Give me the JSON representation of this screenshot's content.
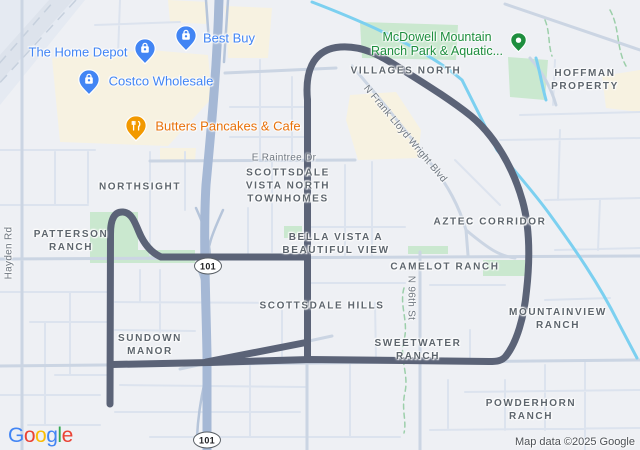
{
  "attribution": "Map data ©2025 Google",
  "logo": {
    "letters": [
      "G",
      "o",
      "o",
      "g",
      "l",
      "e"
    ],
    "colors": [
      "#4285F4",
      "#EA4335",
      "#FBBC04",
      "#4285F4",
      "#34A853",
      "#EA4335"
    ]
  },
  "pois": [
    {
      "name": "the-home-depot",
      "label": "The Home Depot",
      "category": "shopping"
    },
    {
      "name": "best-buy",
      "label": "Best Buy",
      "category": "shopping"
    },
    {
      "name": "costco-wholesale",
      "label": "Costco Wholesale",
      "category": "shopping"
    },
    {
      "name": "butters-pancakes-cafe",
      "label": "Butters Pancakes & Cafe",
      "category": "restaurant"
    },
    {
      "name": "mcdowell-mountain-ranch-park",
      "lines": [
        "McDowell Mountain",
        "Ranch Park & Aquatic..."
      ],
      "category": "park"
    }
  ],
  "neighborhoods": [
    {
      "name": "villages-north",
      "lines": [
        "VILLAGES NORTH"
      ]
    },
    {
      "name": "hoffman-property",
      "lines": [
        "HOFFMAN",
        "PROPERTY"
      ]
    },
    {
      "name": "northsight",
      "lines": [
        "NORTHSIGHT"
      ]
    },
    {
      "name": "patterson-ranch",
      "lines": [
        "PATTERSON",
        "RANCH"
      ]
    },
    {
      "name": "scottsdale-vista-north-townhomes",
      "lines": [
        "SCOTTSDALE",
        "VISTA NORTH",
        "TOWNHOMES"
      ]
    },
    {
      "name": "bella-vista-a-beautiful-view",
      "lines": [
        "BELLA VISTA A",
        "BEAUTIFUL VIEW"
      ]
    },
    {
      "name": "aztec-corridor",
      "lines": [
        "AZTEC CORRIDOR"
      ]
    },
    {
      "name": "camelot-ranch",
      "lines": [
        "CAMELOT RANCH"
      ]
    },
    {
      "name": "scottsdale-hills",
      "lines": [
        "SCOTTSDALE HILLS"
      ]
    },
    {
      "name": "sundown-manor",
      "lines": [
        "SUNDOWN",
        "MANOR"
      ]
    },
    {
      "name": "sweetwater-ranch",
      "lines": [
        "SWEETWATER",
        "RANCH"
      ]
    },
    {
      "name": "mountainview-ranch",
      "lines": [
        "MOUNTAINVIEW",
        "RANCH"
      ]
    },
    {
      "name": "powderhorn-ranch",
      "lines": [
        "POWDERHORN",
        "RANCH"
      ]
    }
  ],
  "road_labels": [
    {
      "name": "e-raintree-dr",
      "text": "E Raintree Dr"
    },
    {
      "name": "n-frank-lloyd-wright-blvd",
      "text": "N Frank Lloyd Wright Blvd"
    },
    {
      "name": "hayden-rd",
      "text": "Hayden Rd"
    },
    {
      "name": "n-96th-st",
      "text": "N 96th St"
    }
  ],
  "highway_shields": [
    {
      "label": "101"
    },
    {
      "label": "101"
    }
  ],
  "colors": {
    "route": "#5b6377",
    "freeway": "#a5b8d5",
    "canal": "#7cd0f0",
    "park_green": "#cae8cf",
    "commercial_beige": "#f7f2e1",
    "poi_blue": "#4285f4",
    "poi_orange": "#e8710a",
    "poi_park_green": "#1e8e3e",
    "neighborhood_gray": "#5d656d"
  }
}
